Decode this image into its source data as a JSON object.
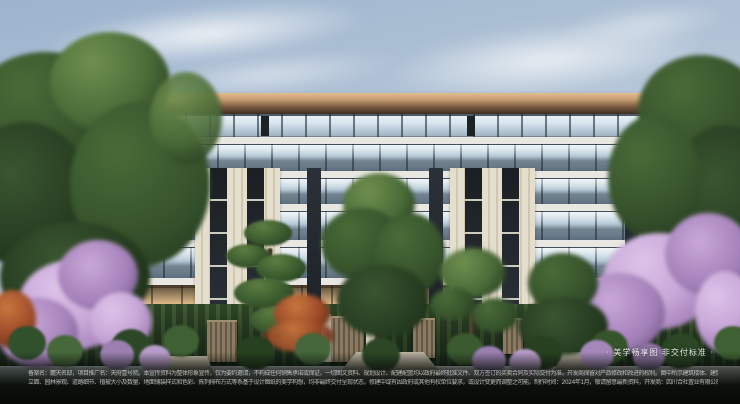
{
  "watermark": {
    "label": "· 美学畅享图 非交付标准 ·"
  },
  "disclaimer": {
    "line1": "备案名：麓天名邸，项目推广名：天府壹号院。本宣传资料为整体形象宣传，仅为要约邀请，不构成任何销售承诺或保证，一切图文资料、规划设计、配建配置均以政府最终批准文件、双方签订的买卖合同及实际交付为准，开发商保留对产品修改和改进的权利。图中所示建筑楼体、建筑",
    "line2": "立面、园林景观、道路细节、植被大小及数量、地面铺装样式和色彩、陈列排布方式等系基于设计图纸的美学构想，均非最终交付呈现状态，修建中或有因政府或其他有权单位要求，或设计变更而调整之可能。制作时间：2024年1月，敬请留意最新资料，开发商：四川合社置业有限公司。"
  },
  "palette": {
    "sky-top": "#9db4ce",
    "sky-bottom": "#d6dee6",
    "roof-light": "#c99f72",
    "roof-dark": "#3c2e22",
    "slab": "#e9e7e1",
    "cream": "#e4decd",
    "glass-light": "#d7e5ee",
    "glass-mid": "#9db3c2",
    "frame-dark": "#1d2227",
    "warm-hi": "#dcb887",
    "fol-dark": "#24391f",
    "fol-mid": "#4a6b38",
    "blossom-light": "#c9a8d8",
    "blossom-mid": "#a27fb8",
    "maple": "#9c4a28",
    "hedge": "#24351f",
    "ground-dark": "#0b100b",
    "path": "#bcb4a4",
    "wood": "#8a7a63",
    "text": "#d3d3d3"
  }
}
